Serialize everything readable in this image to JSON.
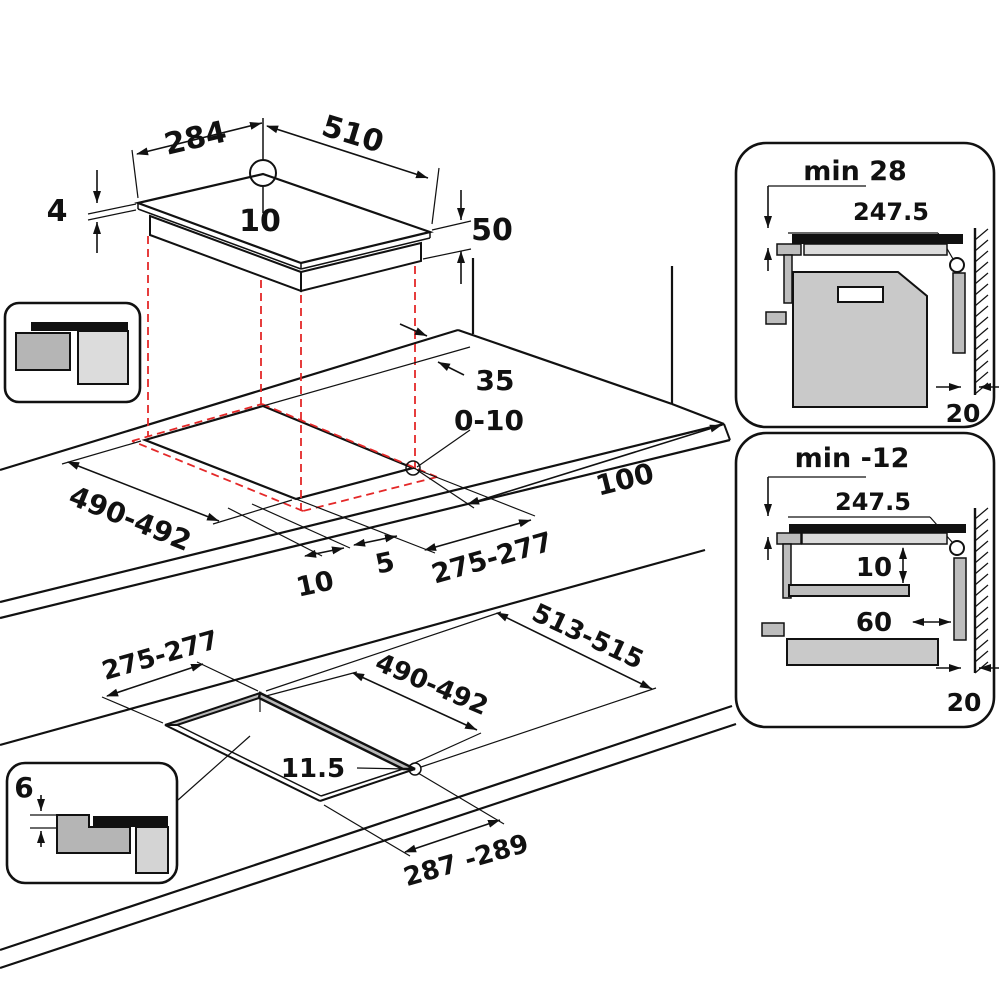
{
  "diagram_title": "Hob installation dimensions drawing",
  "colors": {
    "line": "#111111",
    "projection_red": "#e42828",
    "glass_black": "#111111",
    "cabinet_gray": "#c9c9c9",
    "bracket_gray": "#bdbdbd",
    "counter_light": "#dcdcdc"
  },
  "hob": {
    "width": "284",
    "depth": "510",
    "glass_thickness": "4",
    "center_offset": "10",
    "body_height": "50"
  },
  "surface_cutout": {
    "back_gap": "35",
    "corner_radius": "0-10",
    "side_clearance": "100",
    "depth": "490-492",
    "edge_offset": "10",
    "glass_gap": "5",
    "width": "275-277"
  },
  "flush_cutout": {
    "width": "275-277",
    "outer_depth": "513-515",
    "inner_depth": "490-492",
    "rim_width": "11.5",
    "outer_width": "287 -289"
  },
  "flush_icon": {
    "recess_depth": "6"
  },
  "oven_panel": {
    "min_clearance": "min 28",
    "center_distance": "247.5",
    "wall_gap": "20"
  },
  "shelf_panel": {
    "min_clearance": "min -12",
    "center_distance": "247.5",
    "shelf_gap": "10",
    "shelf_setback": "60",
    "wall_gap": "20"
  }
}
